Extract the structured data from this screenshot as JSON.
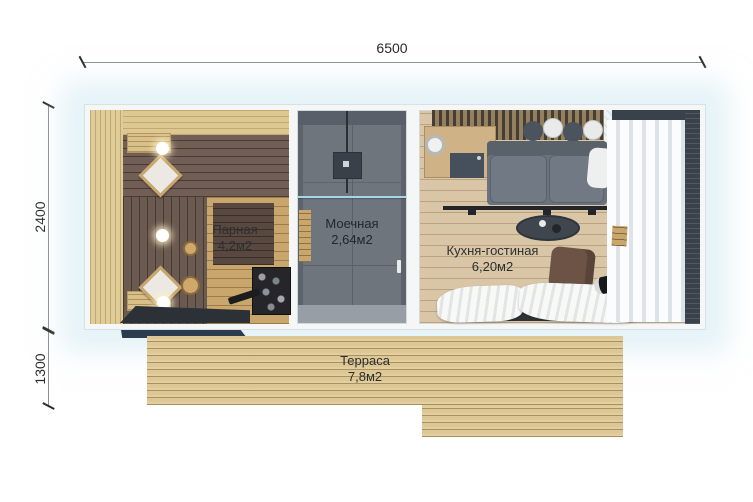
{
  "plan_title": "Floor plan of sauna house with terrace",
  "dimensions": {
    "width": "6500",
    "height": "2400",
    "terrace_depth": "1300"
  },
  "rooms": [
    {
      "name": "Парная",
      "area": "4,2м2"
    },
    {
      "name": "Моечная",
      "area": "2,64м2"
    },
    {
      "name": "Кухня-гостиная",
      "area": "6,20м2"
    },
    {
      "name": "Терраса",
      "area": "7,8м2"
    }
  ],
  "colors": {
    "wall_white": "#f5f7f7",
    "sauna_wood_dark": "#6e5d54",
    "sauna_wood_light": "#e0cc96",
    "wet_room_gray": "#6e757d",
    "kitchen_floor": "#d9c6a7",
    "deck": "#ddc794",
    "step_accent": "#2c3b50",
    "glass_divider": "#a6d7e8",
    "dimension_line": "#8a8f93"
  }
}
